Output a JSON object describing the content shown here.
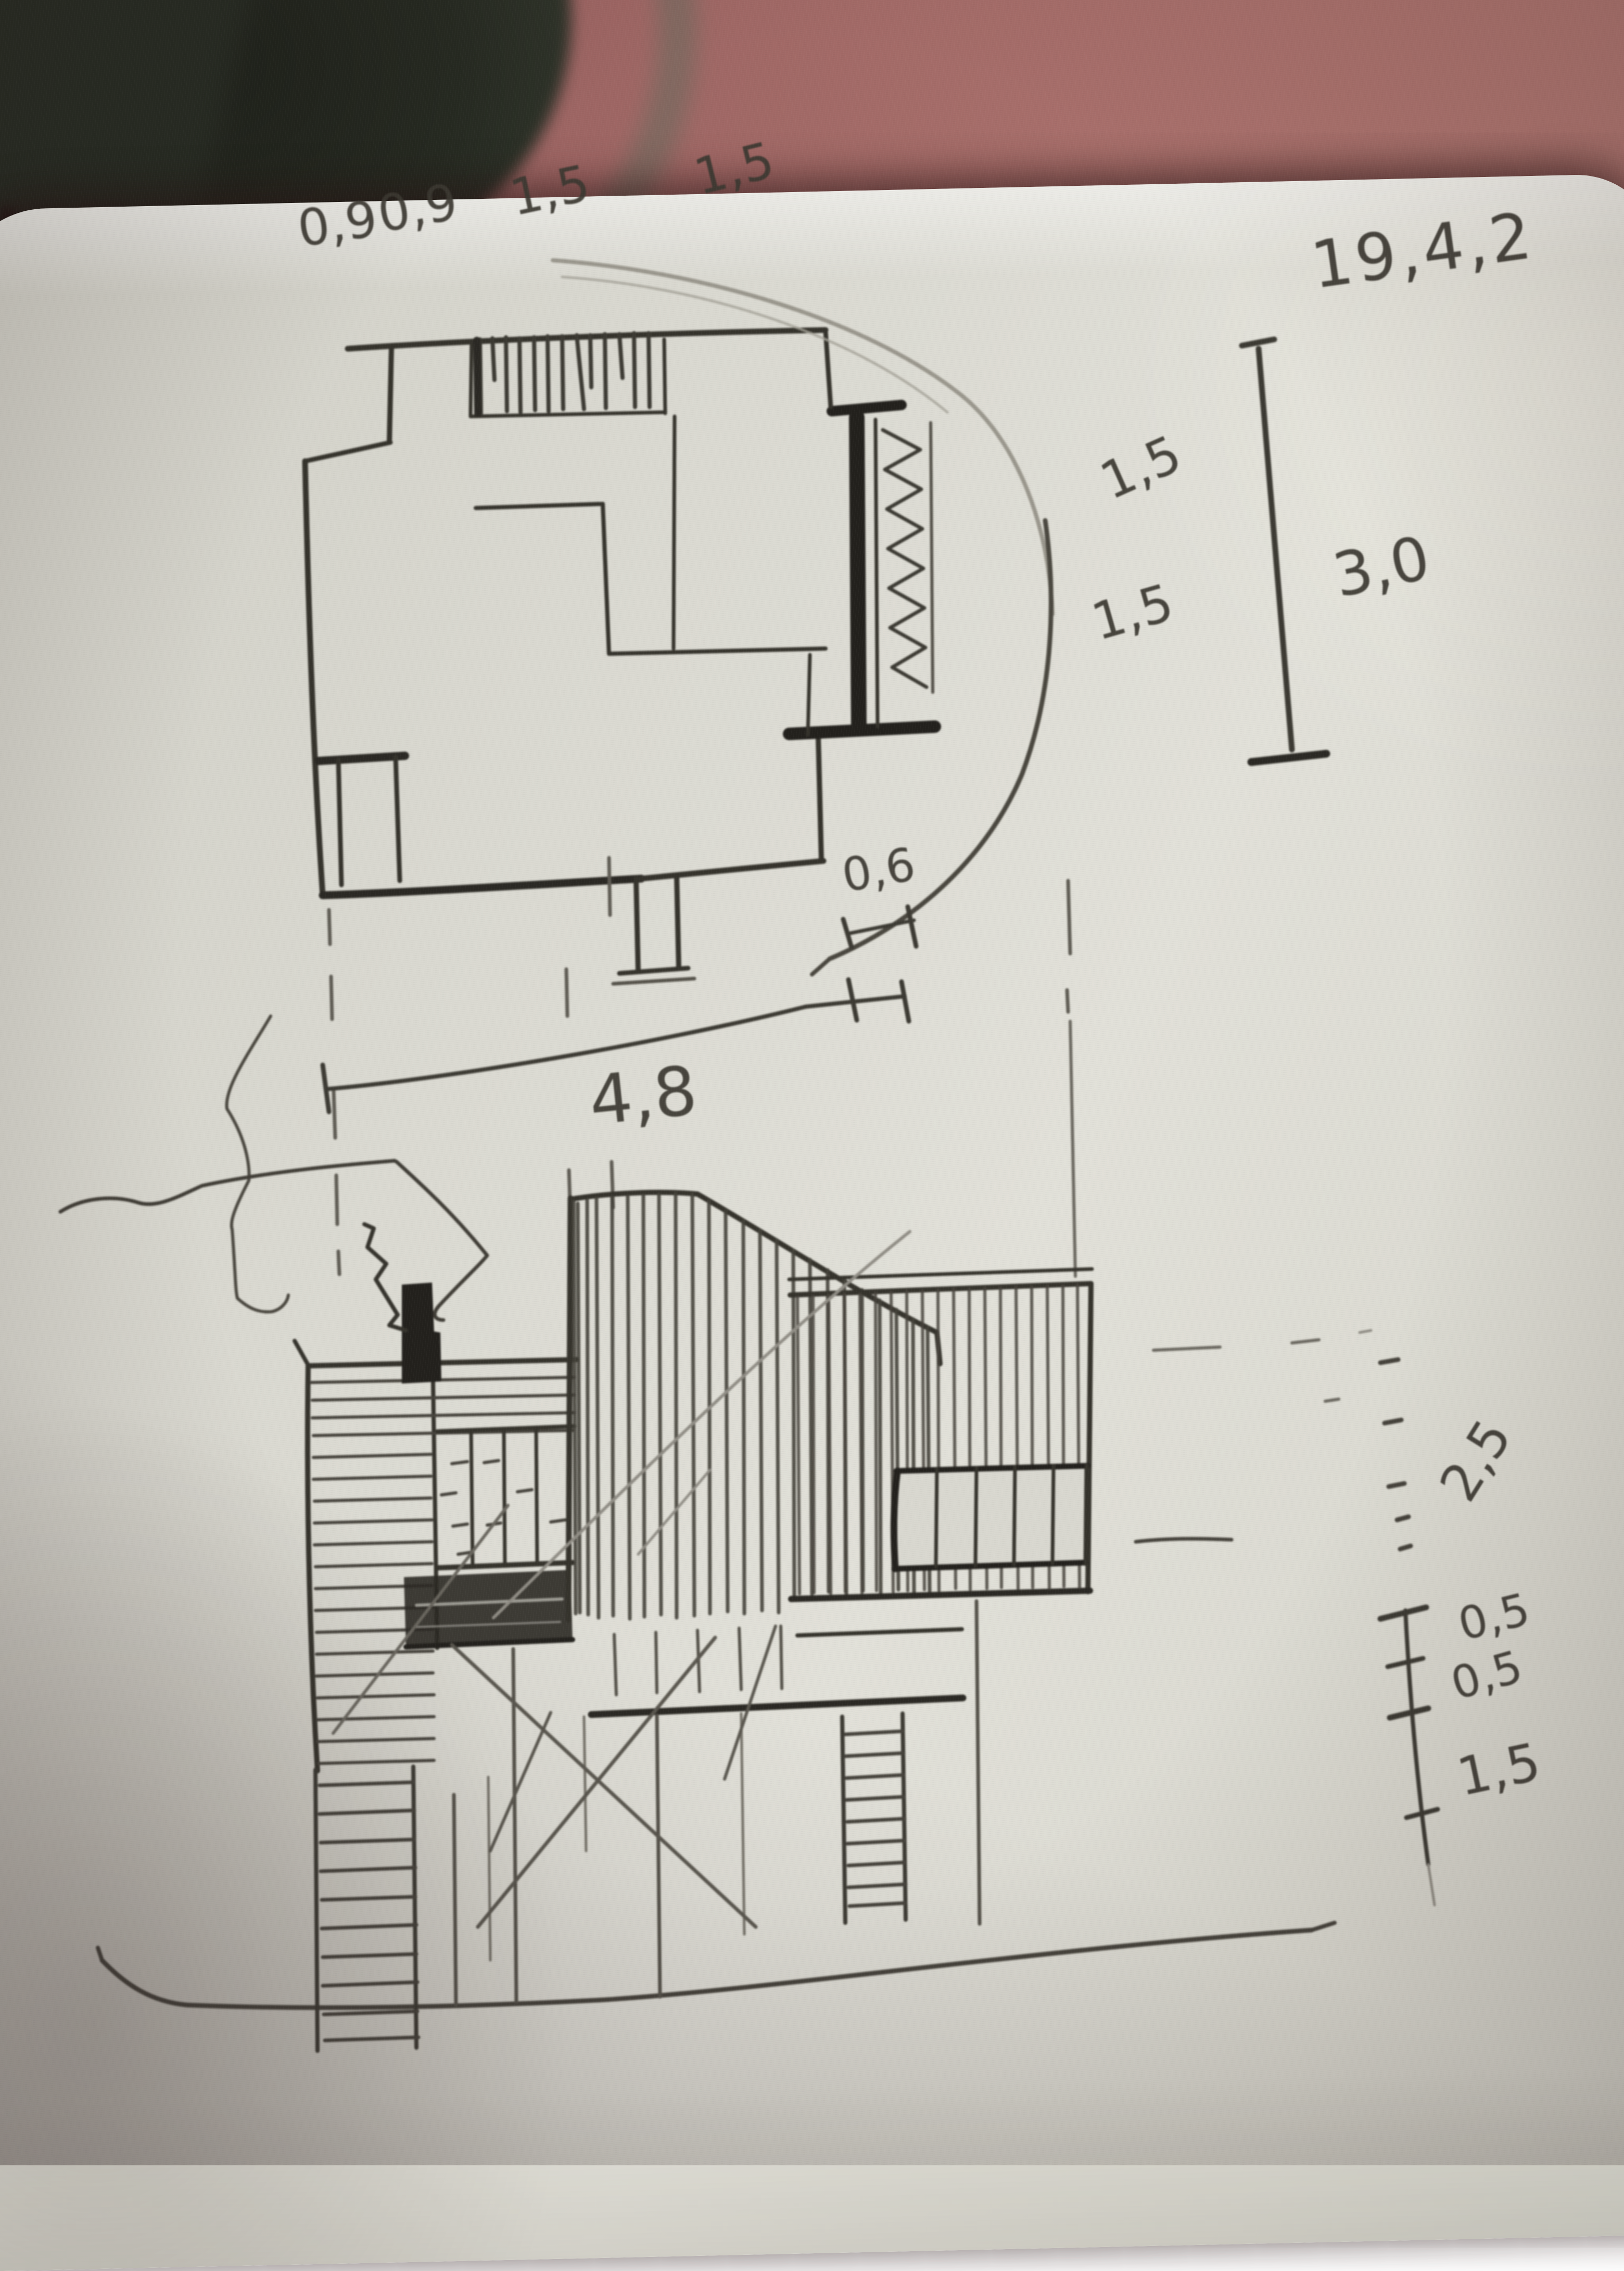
{
  "annotations": {
    "plan_top_1": "0,9",
    "plan_top_2": "0,9",
    "plan_top_3": "1,5",
    "plan_top_4": "1,5",
    "date": "19,4,2",
    "plan_right_1": "1,5",
    "plan_right_2": "1,5",
    "plan_right_total": "3,0",
    "door_width": "0,6",
    "plan_width": "4,8",
    "elev_height_upper": "2,5",
    "elev_step_1": "0,5",
    "elev_step_2": "0,5",
    "elev_base": "1,5"
  },
  "colors": {
    "table_surface": "#a86f6b",
    "paper": "#dbdad2",
    "ink": "#35332c",
    "ink_heavy": "#23211d",
    "pencil": "#908d85",
    "dark_object": "#23271e"
  },
  "scene_parts": {
    "background_object": "dark rounded case on table",
    "notebook": "sketchbook page with architectural sketches",
    "upper_sketch": "floor plan with rounded site outline",
    "lower_sketch": "building elevation with chimney, tower and ribbon window"
  }
}
